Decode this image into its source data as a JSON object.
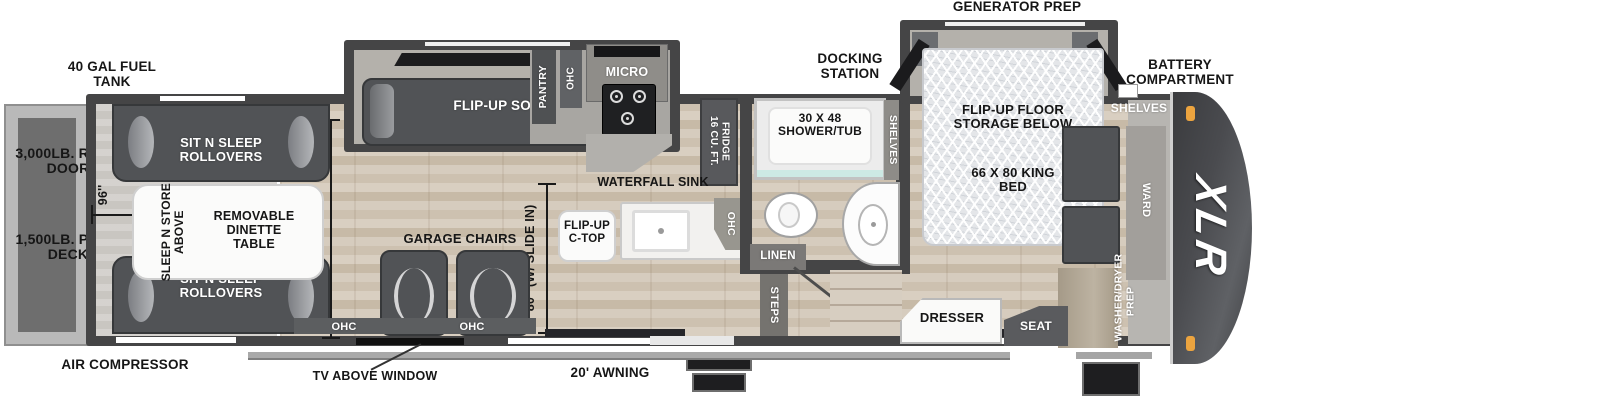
{
  "colors": {
    "wall": "#454546",
    "wood_floor": "#d5cabb",
    "garage_floor": "#c9c6c1",
    "slide_floor": "#b4b1ab",
    "furniture_dark": "#515356",
    "front_cap": "#4a4b4f",
    "clearance_light_orange": "#eca43f",
    "label_dark": "#161616",
    "label_light": "#ffffff"
  },
  "exterior": {
    "fuel_tank": "40 GAL FUEL TANK",
    "generator_prep": "GENERATOR PREP",
    "docking_station": "DOCKING STATION",
    "battery_compartment": "BATTERY COMPARTMENT",
    "ramp_door": "3,000LB. RAMP DOOR",
    "patio_deck": "1,500LB. PATIO DECK",
    "air_compressor": "AIR COMPRESSOR",
    "tv_above_window": "TV ABOVE WINDOW",
    "awning": "20' AWNING"
  },
  "garage": {
    "rollovers": "SIT N SLEEP ROLLOVERS",
    "sleep_n_store": "SLEEP N STORE ABOVE",
    "dinette": "REMOVABLE DINETTE TABLE",
    "chairs": "GARAGE CHAIRS",
    "ohc": "OHC",
    "dim_96": "96''",
    "dim_98": "98''"
  },
  "living": {
    "sofa": "FLIP-UP SOFA",
    "pantry": "PANTRY",
    "ohc": "OHC",
    "micro": "MICRO",
    "fridge": "16 CU. FT. FRIDGE",
    "waterfall_sink": "WATERFALL SINK",
    "ctop": "FLIP-UP C-TOP",
    "dim_80": "80'' (W/ SLIDE IN)"
  },
  "bath": {
    "shower": "30 X 48 SHOWER/TUB",
    "linen": "LINEN",
    "steps": "STEPS",
    "shelves": "SHELVES"
  },
  "bedroom": {
    "floor_storage": "FLIP-UP FLOOR STORAGE BELOW",
    "king_bed": "66 X 80 KING BED",
    "dresser": "DRESSER",
    "seat": "SEAT",
    "shelves": "SHELVES",
    "ward": "WARD",
    "washer_dryer": "WASHER/DRYER PREP"
  },
  "front_cap": {
    "logo": "XLR"
  }
}
